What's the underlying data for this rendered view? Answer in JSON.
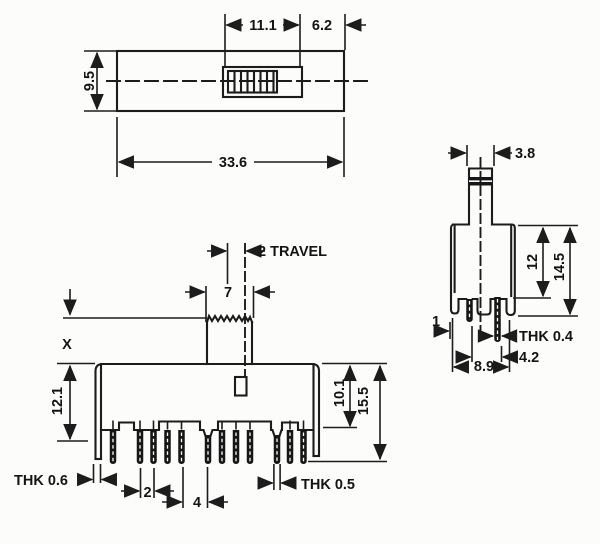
{
  "colors": {
    "ink": "#1c1c1c",
    "paper": "#fcfcfa"
  },
  "top_view": {
    "length": "33.6",
    "height": "9.5",
    "knob_width": "11.1",
    "knob_offset": "6.2"
  },
  "front_view": {
    "travel": "2 TRAVEL",
    "actuator_width": "7",
    "actuator_height": "X",
    "body_height": "12.1",
    "body_to_seat": "10.1",
    "total_height": "15.5",
    "leg_thickness": "THK 0.6",
    "pin_pitch": "2",
    "group_pitch": "4",
    "pin_thickness": "THK 0.5"
  },
  "side_view": {
    "actuator_width": "3.8",
    "body_height": "12",
    "total_height": "14.5",
    "bracket_thickness": "1",
    "contact_thickness": "THK 0.4",
    "terminal_offset": "4.2",
    "body_width": "8.9"
  }
}
